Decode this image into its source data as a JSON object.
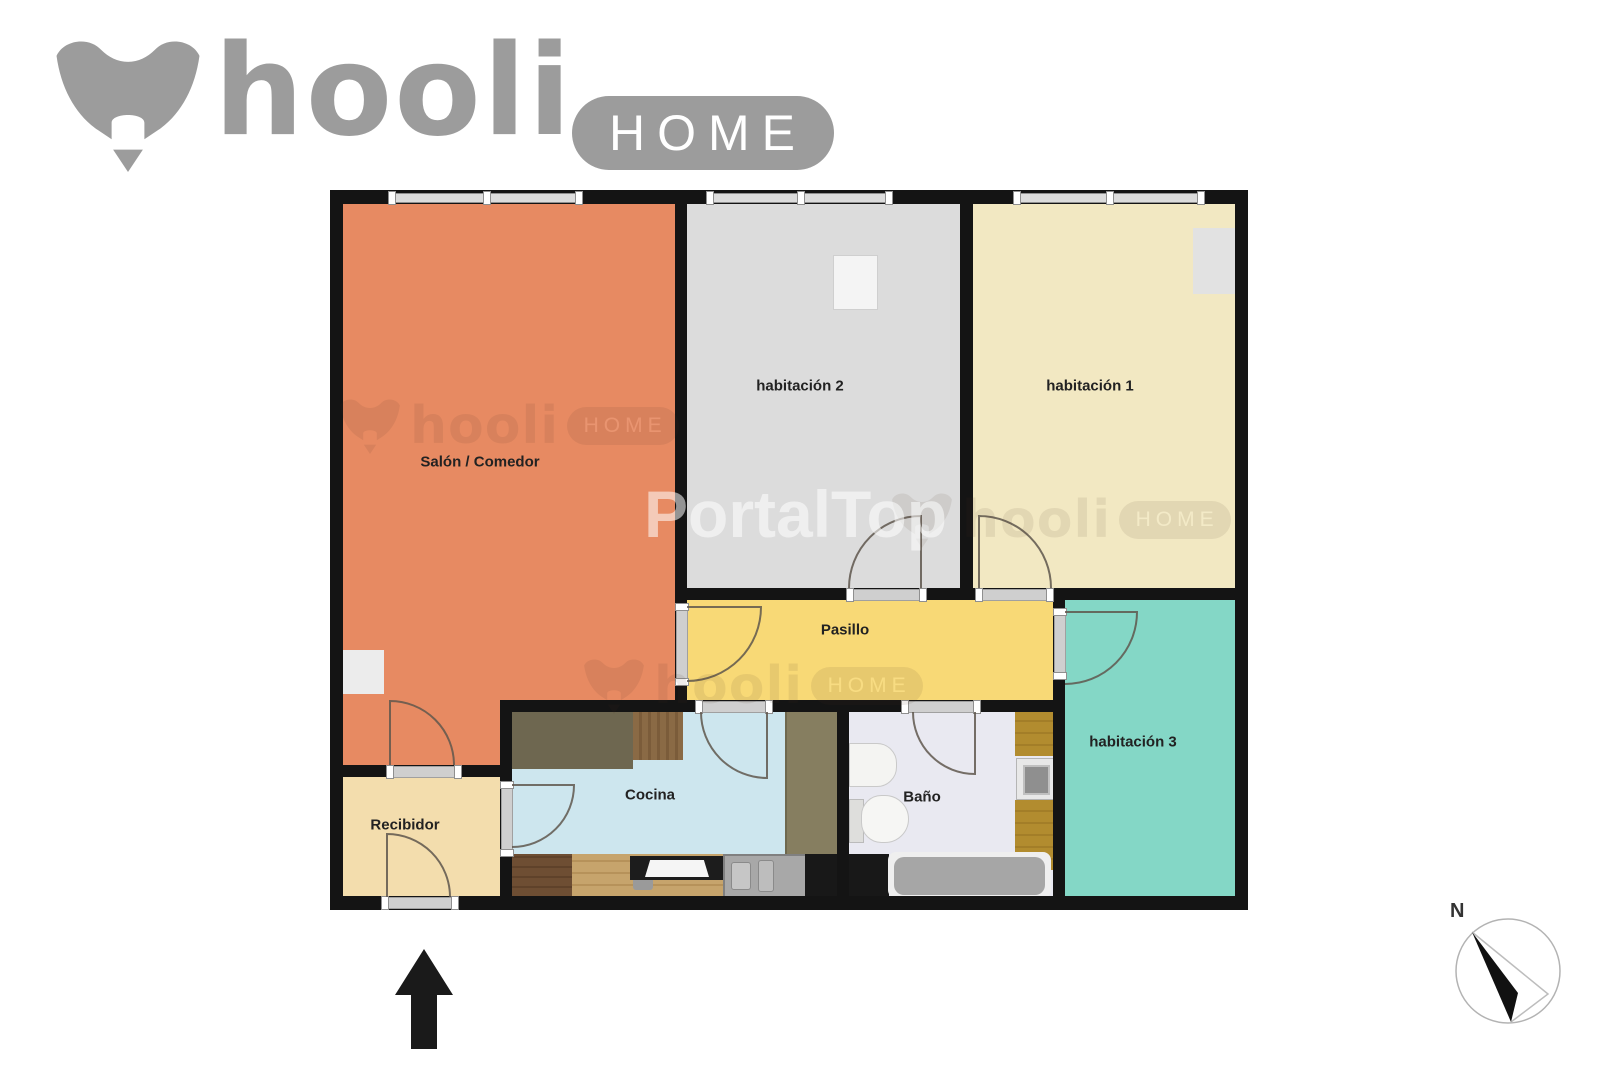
{
  "header": {
    "brand": "hooli",
    "badge": "HOME",
    "brand_color": "#9c9c9c"
  },
  "watermarks": {
    "portal": "PortalTop",
    "brand": "hooli",
    "badge": "HOME"
  },
  "compass": {
    "north": "N"
  },
  "plan": {
    "wall_color": "#141414",
    "rooms": {
      "salon": {
        "label": "Salón / Comedor",
        "color": "#e78a62"
      },
      "habitacion2": {
        "label": "habitación 2",
        "color": "#dcdcdc"
      },
      "habitacion1": {
        "label": "habitación 1",
        "color": "#f2e8c2"
      },
      "pasillo": {
        "label": "Pasillo",
        "color": "#f8d976"
      },
      "habitacion3": {
        "label": "habitación 3",
        "color": "#84d7c6"
      },
      "cocina": {
        "label": "Cocina",
        "color": "#cde6ee"
      },
      "bano": {
        "label": "Baño",
        "color": "#e9e9f1"
      },
      "recibidor": {
        "label": "Recibidor",
        "color": "#f3ddad"
      }
    }
  }
}
